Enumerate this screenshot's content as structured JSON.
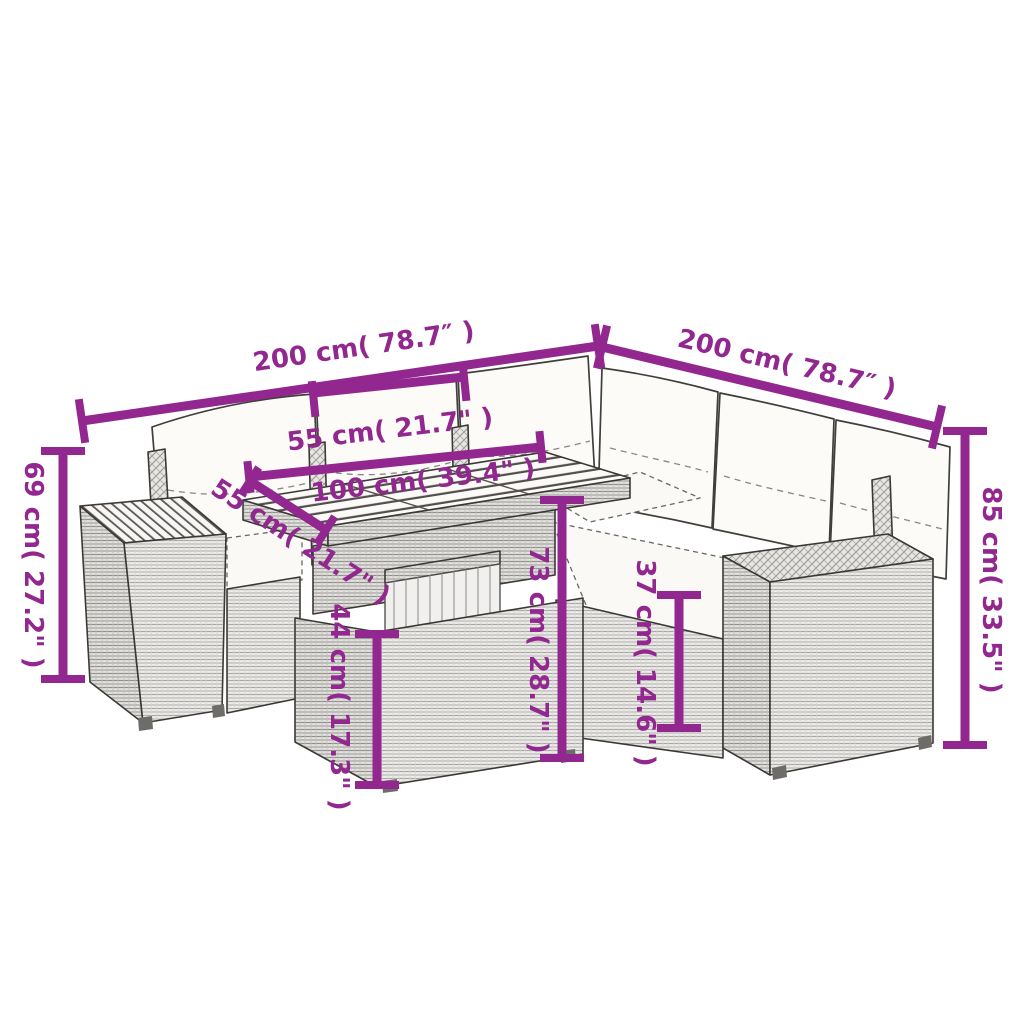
{
  "meta": {
    "type": "product-dimension-diagram",
    "subject": "rattan garden corner sofa set with cushions and acacia-top table",
    "background_color": "#ffffff",
    "accent_color": "#92278f",
    "line_art_color": "#3b3936"
  },
  "dimensions": {
    "left_width": {
      "label": "200 cm( 78.7″ )"
    },
    "right_width": {
      "label": "200 cm( 78.7″ )"
    },
    "seat_width": {
      "label": "55 cm( 21.7\" )"
    },
    "table_length": {
      "label": "100 cm( 39.4\" )"
    },
    "table_depth": {
      "label": "55 cm( 21.7\" )"
    },
    "table_height": {
      "label": "73 cm( 28.7\" )"
    },
    "table_base_height": {
      "label": "44 cm( 17.3\" )"
    },
    "seat_height": {
      "label": "37 cm( 14.6\" )"
    },
    "armrest_height": {
      "label": "69 cm( 27.2\" )"
    },
    "back_height": {
      "label": "85 cm( 33.5\" )"
    }
  }
}
